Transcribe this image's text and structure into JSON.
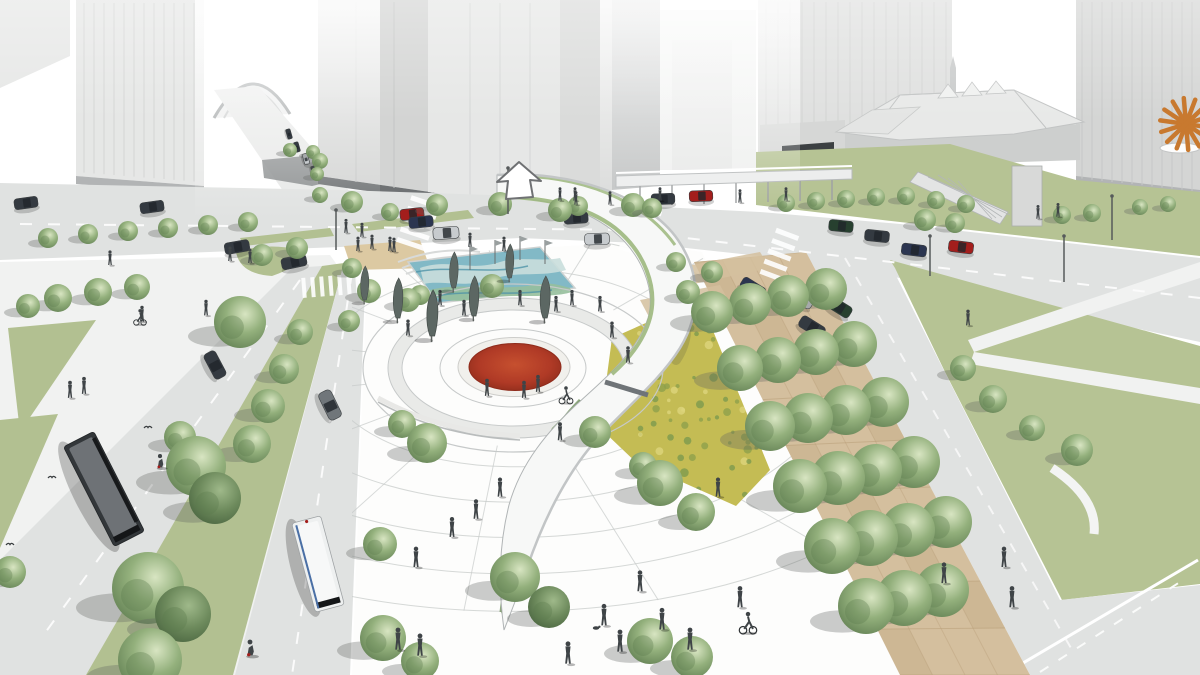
{
  "scene": {
    "type": "architectural-rendering",
    "subject": "Aerial rendering of an urban plaza: S-curved pedestrian ramp, circular paving with red planted center, reflecting pool, wildflower meadow, tree promenade, boulevards with buses and cars, gray massing buildings",
    "palette": {
      "bg": "#ffffff",
      "road": "#e0e2e1",
      "roadShade": "#d7d9d9",
      "sidewalk": "#f1f2f1",
      "plaza": "#fdfdfc",
      "line": "#c7cbca",
      "lawn": "#b6c394",
      "median": "#b2c091",
      "hedge": "#7da262",
      "hedgeDark": "#5f854c",
      "meadow": "#c4bc54",
      "meadowDark": "#8fa04b",
      "meadowLight": "#ddd57c",
      "pavers": "#d4bf9e",
      "paversDark": "#b89f79",
      "water": "#82b9c6",
      "waterLight": "#c9dedb",
      "waterGreen": "#96bf9c",
      "waterDark": "#4f93a8",
      "red1": "#b8402c",
      "red2": "#8f2b1b",
      "bld1": "#e6e7e6",
      "bld2": "#d3d4d3",
      "bld3": "#c2c4c4",
      "bldSide": "#b2b4b5",
      "bldDark": "#6f7274",
      "outline": "#969a9b",
      "treeLight": "#d8e5c2",
      "tree": "#8fac7a",
      "treeDark": "#5c7a4e",
      "trunk": "#7a7060",
      "shadow": "#5f6360",
      "person": "#3f4447",
      "rampFill": "#f7f8f7",
      "rampEdge": "#b0b4b5",
      "rampGreen": "#9cb77d",
      "orange": "#c8792f",
      "vehicles": {
        "dark": "#343a41",
        "navy": "#2b3550",
        "red": "#a31e1c",
        "silver": "#c7cbce",
        "green": "#27402f",
        "gray": "#70767a",
        "white": "#eef0f1"
      },
      "busDarkBody": "#33373a",
      "busDarkRoof": "#6e7276",
      "busWhiteBody": "#eef0f0",
      "busStripe": "#4a6fa5"
    }
  },
  "props": {
    "arrow_sign": {
      "meaning": "up-arrow wayfinding sign on facade"
    },
    "asterisk_sculpture": {
      "spokes": 7,
      "color": "#c8792f"
    }
  },
  "entities": {
    "trees": [
      [
        300,
        332,
        13
      ],
      [
        284,
        369,
        15
      ],
      [
        268,
        406,
        17
      ],
      [
        252,
        444,
        19
      ],
      [
        196,
        466,
        30
      ],
      [
        215,
        498,
        26,
        1
      ],
      [
        180,
        437,
        16
      ],
      [
        148,
        588,
        36
      ],
      [
        183,
        614,
        28,
        1
      ],
      [
        150,
        660,
        32
      ],
      [
        58,
        298,
        14
      ],
      [
        98,
        292,
        14
      ],
      [
        137,
        287,
        13
      ],
      [
        28,
        306,
        12
      ],
      [
        10,
        572,
        16
      ],
      [
        48,
        238,
        10
      ],
      [
        88,
        234,
        10
      ],
      [
        128,
        231,
        10
      ],
      [
        168,
        228,
        10
      ],
      [
        208,
        225,
        10
      ],
      [
        248,
        222,
        10
      ],
      [
        240,
        322,
        26
      ],
      [
        262,
        255,
        11
      ],
      [
        297,
        248,
        11
      ],
      [
        352,
        202,
        11
      ],
      [
        390,
        212,
        9
      ],
      [
        437,
        205,
        11
      ],
      [
        500,
        204,
        12
      ],
      [
        560,
        210,
        12
      ],
      [
        578,
        206,
        10
      ],
      [
        633,
        205,
        12
      ],
      [
        652,
        208,
        10
      ],
      [
        313,
        152,
        7
      ],
      [
        317,
        174,
        7
      ],
      [
        320,
        195,
        8
      ],
      [
        290,
        150,
        7
      ],
      [
        320,
        161,
        8
      ],
      [
        786,
        203,
        9
      ],
      [
        816,
        201,
        9
      ],
      [
        846,
        199,
        9
      ],
      [
        876,
        197,
        9
      ],
      [
        906,
        196,
        9
      ],
      [
        936,
        200,
        9
      ],
      [
        966,
        204,
        9
      ],
      [
        925,
        220,
        11
      ],
      [
        955,
        223,
        10
      ],
      [
        1062,
        215,
        9
      ],
      [
        1092,
        213,
        9
      ],
      [
        1140,
        207,
        8
      ],
      [
        1168,
        204,
        8
      ],
      [
        963,
        368,
        13
      ],
      [
        993,
        399,
        14
      ],
      [
        1032,
        428,
        13
      ],
      [
        1077,
        450,
        16
      ],
      [
        712,
        312,
        21
      ],
      [
        750,
        304,
        21
      ],
      [
        788,
        296,
        21
      ],
      [
        826,
        289,
        21
      ],
      [
        740,
        368,
        23
      ],
      [
        778,
        360,
        23
      ],
      [
        816,
        352,
        23
      ],
      [
        854,
        344,
        23
      ],
      [
        770,
        426,
        25
      ],
      [
        808,
        418,
        25
      ],
      [
        846,
        410,
        25
      ],
      [
        884,
        402,
        25
      ],
      [
        800,
        486,
        27
      ],
      [
        838,
        478,
        27
      ],
      [
        876,
        470,
        26
      ],
      [
        914,
        462,
        26
      ],
      [
        832,
        546,
        28
      ],
      [
        870,
        538,
        28
      ],
      [
        908,
        530,
        27
      ],
      [
        946,
        522,
        26
      ],
      [
        866,
        606,
        28
      ],
      [
        904,
        598,
        28
      ],
      [
        942,
        590,
        27
      ],
      [
        427,
        443,
        20
      ],
      [
        402,
        424,
        14
      ],
      [
        595,
        432,
        16
      ],
      [
        643,
        466,
        14
      ],
      [
        660,
        483,
        23
      ],
      [
        696,
        512,
        19
      ],
      [
        515,
        577,
        25
      ],
      [
        549,
        607,
        21,
        1
      ],
      [
        380,
        544,
        17
      ],
      [
        383,
        638,
        23
      ],
      [
        420,
        661,
        19
      ],
      [
        650,
        641,
        23
      ],
      [
        692,
        657,
        21
      ],
      [
        352,
        268,
        10
      ],
      [
        369,
        291,
        12
      ],
      [
        349,
        321,
        11
      ],
      [
        408,
        300,
        12
      ],
      [
        420,
        295,
        10
      ],
      [
        492,
        286,
        12
      ],
      [
        676,
        262,
        10
      ],
      [
        712,
        272,
        11
      ],
      [
        688,
        292,
        12
      ]
    ],
    "people": [
      [
        600,
        306
      ],
      [
        572,
        300
      ],
      [
        612,
        332
      ],
      [
        628,
        357
      ],
      [
        538,
        386
      ],
      [
        524,
        392
      ],
      [
        487,
        390
      ],
      [
        560,
        434
      ],
      [
        500,
        490
      ],
      [
        476,
        512
      ],
      [
        452,
        530
      ],
      [
        416,
        560
      ],
      [
        640,
        584
      ],
      [
        662,
        622
      ],
      [
        690,
        642
      ],
      [
        620,
        644
      ],
      [
        740,
        600
      ],
      [
        568,
        656
      ],
      [
        420,
        648
      ],
      [
        398,
        642
      ],
      [
        604,
        618
      ],
      [
        358,
        246
      ],
      [
        372,
        244
      ],
      [
        394,
        247
      ],
      [
        440,
        300
      ],
      [
        464,
        310
      ],
      [
        408,
        330
      ],
      [
        520,
        300
      ],
      [
        556,
        306
      ],
      [
        346,
        228
      ],
      [
        362,
        232
      ],
      [
        390,
        246
      ],
      [
        470,
        242
      ],
      [
        504,
        246
      ],
      [
        610,
        200
      ],
      [
        575,
        196
      ],
      [
        560,
        196
      ],
      [
        576,
        200
      ],
      [
        660,
        196
      ],
      [
        740,
        198
      ],
      [
        786,
        196
      ],
      [
        206,
        310
      ],
      [
        142,
        316
      ],
      [
        84,
        388
      ],
      [
        70,
        392
      ],
      [
        250,
        258
      ],
      [
        230,
        256
      ],
      [
        110,
        260
      ],
      [
        944,
        576
      ],
      [
        1004,
        560
      ],
      [
        1012,
        600
      ],
      [
        1038,
        214
      ],
      [
        1058,
        212
      ],
      [
        718,
        490
      ],
      [
        968,
        320
      ]
    ],
    "cars": [
      [
        26,
        203,
        -8,
        "dark"
      ],
      [
        152,
        207,
        -8,
        "dark"
      ],
      [
        237,
        247,
        -10,
        "dark"
      ],
      [
        294,
        262,
        -12,
        "dark"
      ],
      [
        412,
        214,
        -6,
        "red"
      ],
      [
        421,
        222,
        -6,
        "navy"
      ],
      [
        446,
        233,
        -4,
        "silver",
        26
      ],
      [
        576,
        218,
        -4,
        "dark"
      ],
      [
        597,
        239,
        -2,
        "silver"
      ],
      [
        663,
        199,
        -2,
        "dark"
      ],
      [
        701,
        196,
        -2,
        "red"
      ],
      [
        841,
        226,
        6,
        "green"
      ],
      [
        877,
        236,
        6,
        "dark"
      ],
      [
        914,
        250,
        7,
        "navy"
      ],
      [
        961,
        247,
        7,
        "red"
      ],
      [
        753,
        288,
        32,
        "navy"
      ],
      [
        801,
        298,
        32,
        "silver"
      ],
      [
        839,
        307,
        32,
        "green"
      ],
      [
        812,
        327,
        32,
        "dark"
      ],
      [
        215,
        365,
        62,
        "dark"
      ],
      [
        330,
        405,
        64,
        "gray",
        30
      ],
      [
        289,
        134,
        74,
        "dark",
        10
      ],
      [
        297,
        147,
        74,
        "dark",
        10
      ],
      [
        306,
        159,
        74,
        "silver",
        11
      ],
      [
        314,
        171,
        74,
        "dark",
        10
      ]
    ],
    "buses": [
      [
        104,
        489,
        63,
        "dark"
      ],
      [
        318,
        564,
        75,
        "white"
      ]
    ],
    "cyclists": [
      [
        566,
        396
      ],
      [
        748,
        624
      ],
      [
        140,
        318
      ]
    ],
    "motos": [
      [
        160,
        462
      ],
      [
        250,
        649
      ]
    ],
    "dogs": [
      [
        596,
        628
      ]
    ],
    "sails": [
      [
        363,
        300,
        34
      ],
      [
        396,
        318,
        40
      ],
      [
        430,
        336,
        46
      ],
      [
        452,
        288,
        36
      ],
      [
        472,
        316,
        40
      ],
      [
        508,
        278,
        34
      ],
      [
        543,
        318,
        42
      ]
    ],
    "flags": [
      [
        470,
        270
      ],
      [
        495,
        264
      ],
      [
        520,
        260
      ],
      [
        545,
        264
      ]
    ],
    "lamps": [
      [
        508,
        214,
        46
      ],
      [
        336,
        250,
        40
      ],
      [
        1112,
        240,
        44
      ],
      [
        1064,
        282,
        46
      ],
      [
        930,
        276,
        40
      ]
    ],
    "birds": [
      [
        52,
        478
      ],
      [
        10,
        545
      ],
      [
        148,
        428
      ]
    ]
  }
}
